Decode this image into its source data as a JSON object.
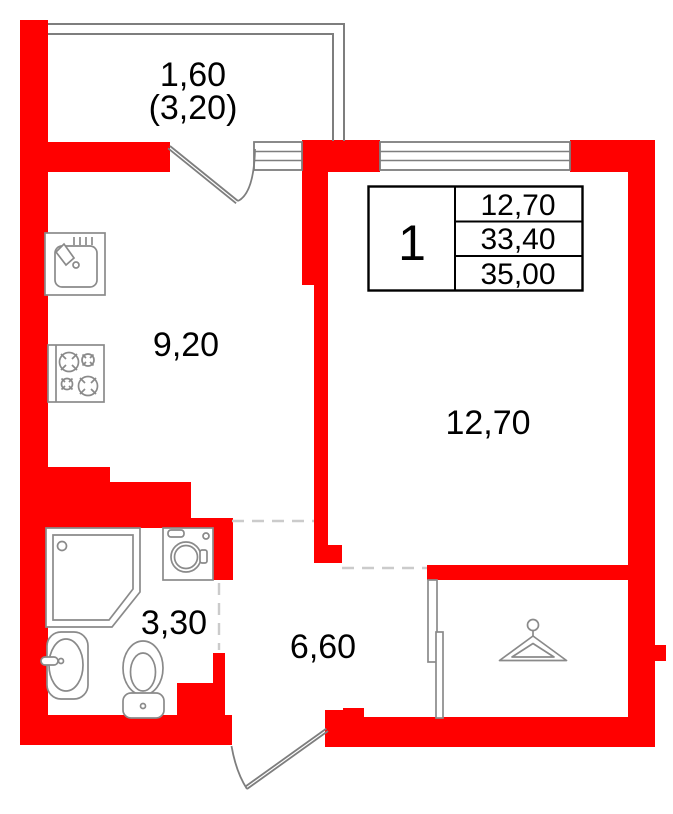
{
  "colors": {
    "wall": "#ff0000",
    "glazing": "#7e7e7e",
    "fixture_outline": "#8a8a8a",
    "dashed_opening": "#cbcbcb",
    "table_border": "#000000",
    "text": "#000000",
    "background": "#ffffff"
  },
  "areas": {
    "balcony_depth": "1,60",
    "balcony_total": "(3,20)",
    "kitchen": "9,20",
    "room": "12,70",
    "bathroom": "3,30",
    "hallway": "6,60"
  },
  "info_table": {
    "rooms": "1",
    "rows": [
      "12,70",
      "33,40",
      "35,00"
    ]
  },
  "icons": {
    "kitchen-sink-icon": "kitchen sink with faucet",
    "stove-icon": "four-burner stove",
    "shower-icon": "corner shower tray",
    "washing-machine-icon": "washing machine",
    "bath-sink-icon": "washbasin",
    "toilet-icon": "toilet",
    "hanger-icon": "clothes hanger",
    "balcony-door-icon": "door swing",
    "entrance-door-icon": "door swing"
  }
}
